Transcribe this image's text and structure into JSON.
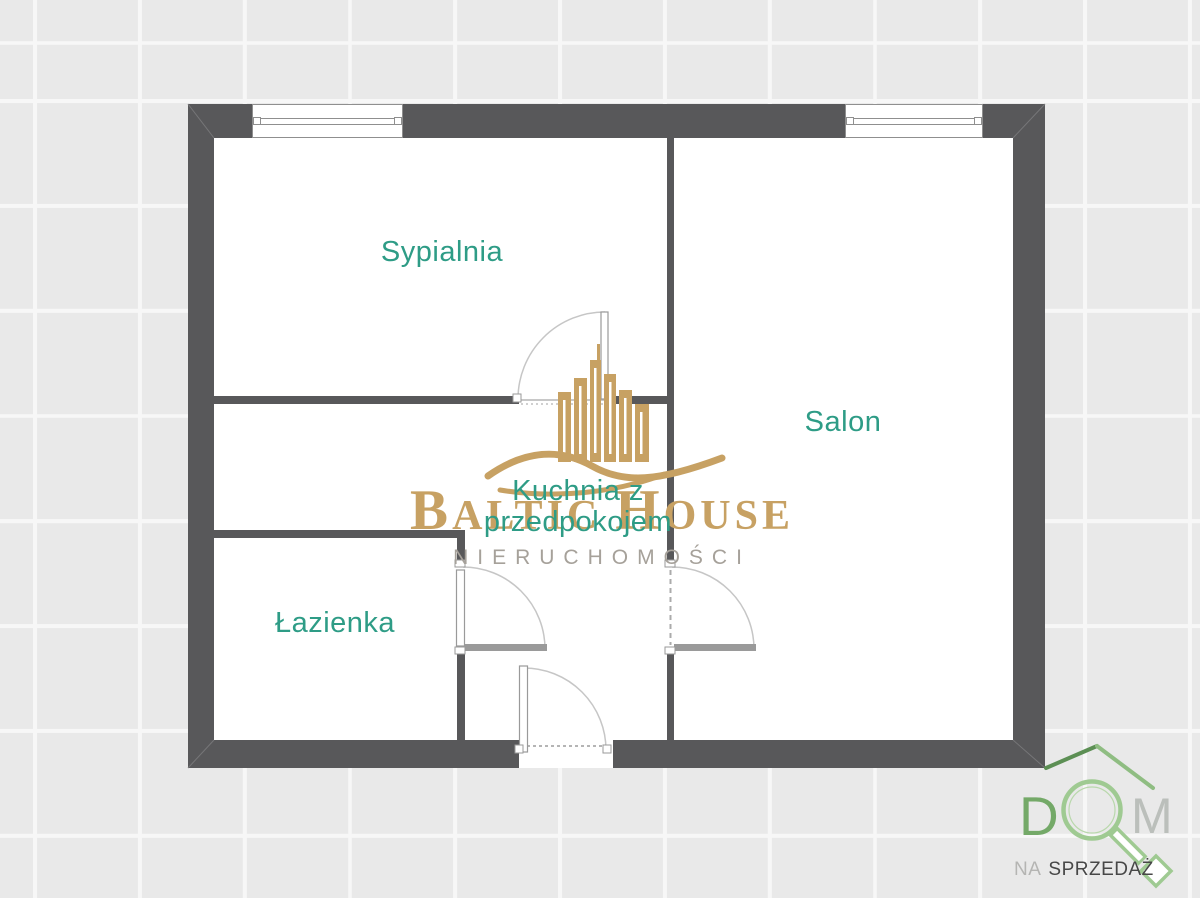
{
  "canvas": {
    "width": 1200,
    "height": 898
  },
  "colors": {
    "background_tile": "#e9e9e9",
    "grid_line": "#f7f7f7",
    "wall": "#58585a",
    "room_label": "#2e9c86",
    "door_arc": "#c6c6c6",
    "door_leaf": "#9a9a9a",
    "brand_gold": "#c7a163",
    "brand_gray": "#a6a19a",
    "logo_green_dark": "#5c8f54",
    "logo_green": "#74a968",
    "logo_green_light": "#9fca92",
    "logo_letter_m_gray": "#bbbfbb",
    "tagline_dark": "#474747",
    "tagline_light": "#b5b5b3"
  },
  "rooms": {
    "sypialnia": {
      "label": "Sypialnia"
    },
    "salon": {
      "label": "Salon"
    },
    "kuchnia": {
      "line1": "Kuchnia z",
      "line2": "przedpokojem"
    },
    "lazienka": {
      "label": "Łazienka"
    }
  },
  "watermark": {
    "brand_initial_1": "B",
    "brand_rest_1": "ALTIC",
    "brand_initial_2": "H",
    "brand_rest_2": "OUSE",
    "subtitle": "NIERUCHOMOŚCI"
  },
  "logo": {
    "letter_d": "D",
    "letter_m": "M",
    "tagline_word_1": "NA",
    "tagline_word_2": "SPRZEDAŻ"
  }
}
